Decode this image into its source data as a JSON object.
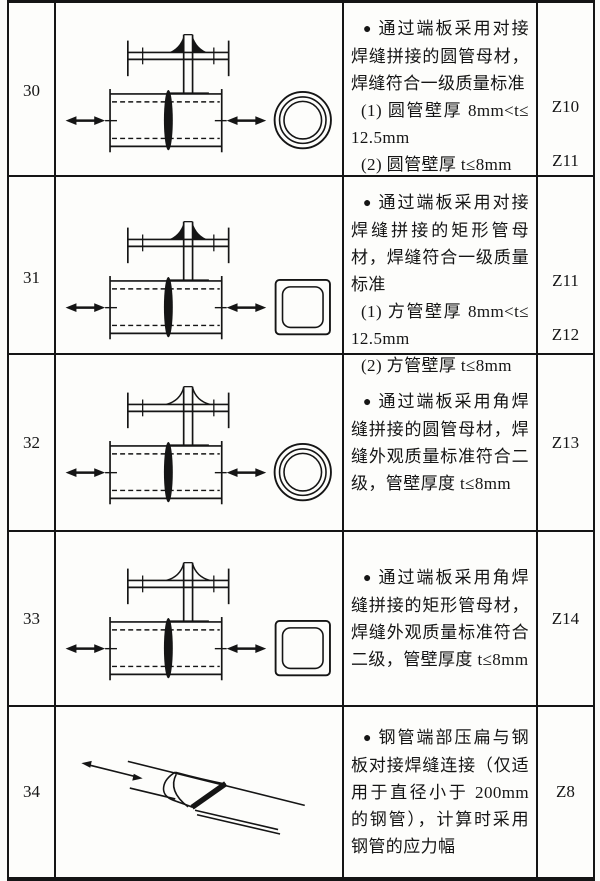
{
  "colors": {
    "ink": "#151515",
    "paper": "#fbfbf9"
  },
  "table": {
    "bullet": "●",
    "rows": [
      {
        "no": "30",
        "description": "通过端板采用对接焊缝拼接的圆管母材，焊缝符合一级质量标准",
        "items": [
          {
            "text": "(1) 圆管壁厚 8mm<t≤12.5mm",
            "category": "Z10"
          },
          {
            "text": "(2) 圆管壁厚 t≤8mm",
            "category": "Z11"
          }
        ],
        "diagram": "end-plate-butt-weld-round-tube-diagram"
      },
      {
        "no": "31",
        "description": "通过端板采用对接焊缝拼接的矩形管母材，焊缝符合一级质量标准",
        "items": [
          {
            "text": "(1) 方管壁厚 8mm<t≤12.5mm",
            "category": "Z11"
          },
          {
            "text": "(2) 方管壁厚 t≤8mm",
            "category": "Z12"
          }
        ],
        "diagram": "end-plate-butt-weld-square-tube-diagram"
      },
      {
        "no": "32",
        "description": "通过端板采用角焊缝拼接的圆管母材，焊缝外观质量标准符合二级，管壁厚度 t≤8mm",
        "category": "Z13",
        "diagram": "end-plate-fillet-weld-round-tube-diagram"
      },
      {
        "no": "33",
        "description": "通过端板采用角焊缝拼接的矩形管母材，焊缝外观质量标准符合二级，管壁厚度 t≤8mm",
        "category": "Z14",
        "diagram": "end-plate-fillet-weld-square-tube-diagram"
      },
      {
        "no": "34",
        "description": "钢管端部压扁与钢板对接焊缝连接（仅适用于直径小于 200mm 的钢管），计算时采用钢管的应力幅",
        "category": "Z8",
        "diagram": "flattened-tube-to-plate-butt-weld-diagram"
      }
    ]
  }
}
